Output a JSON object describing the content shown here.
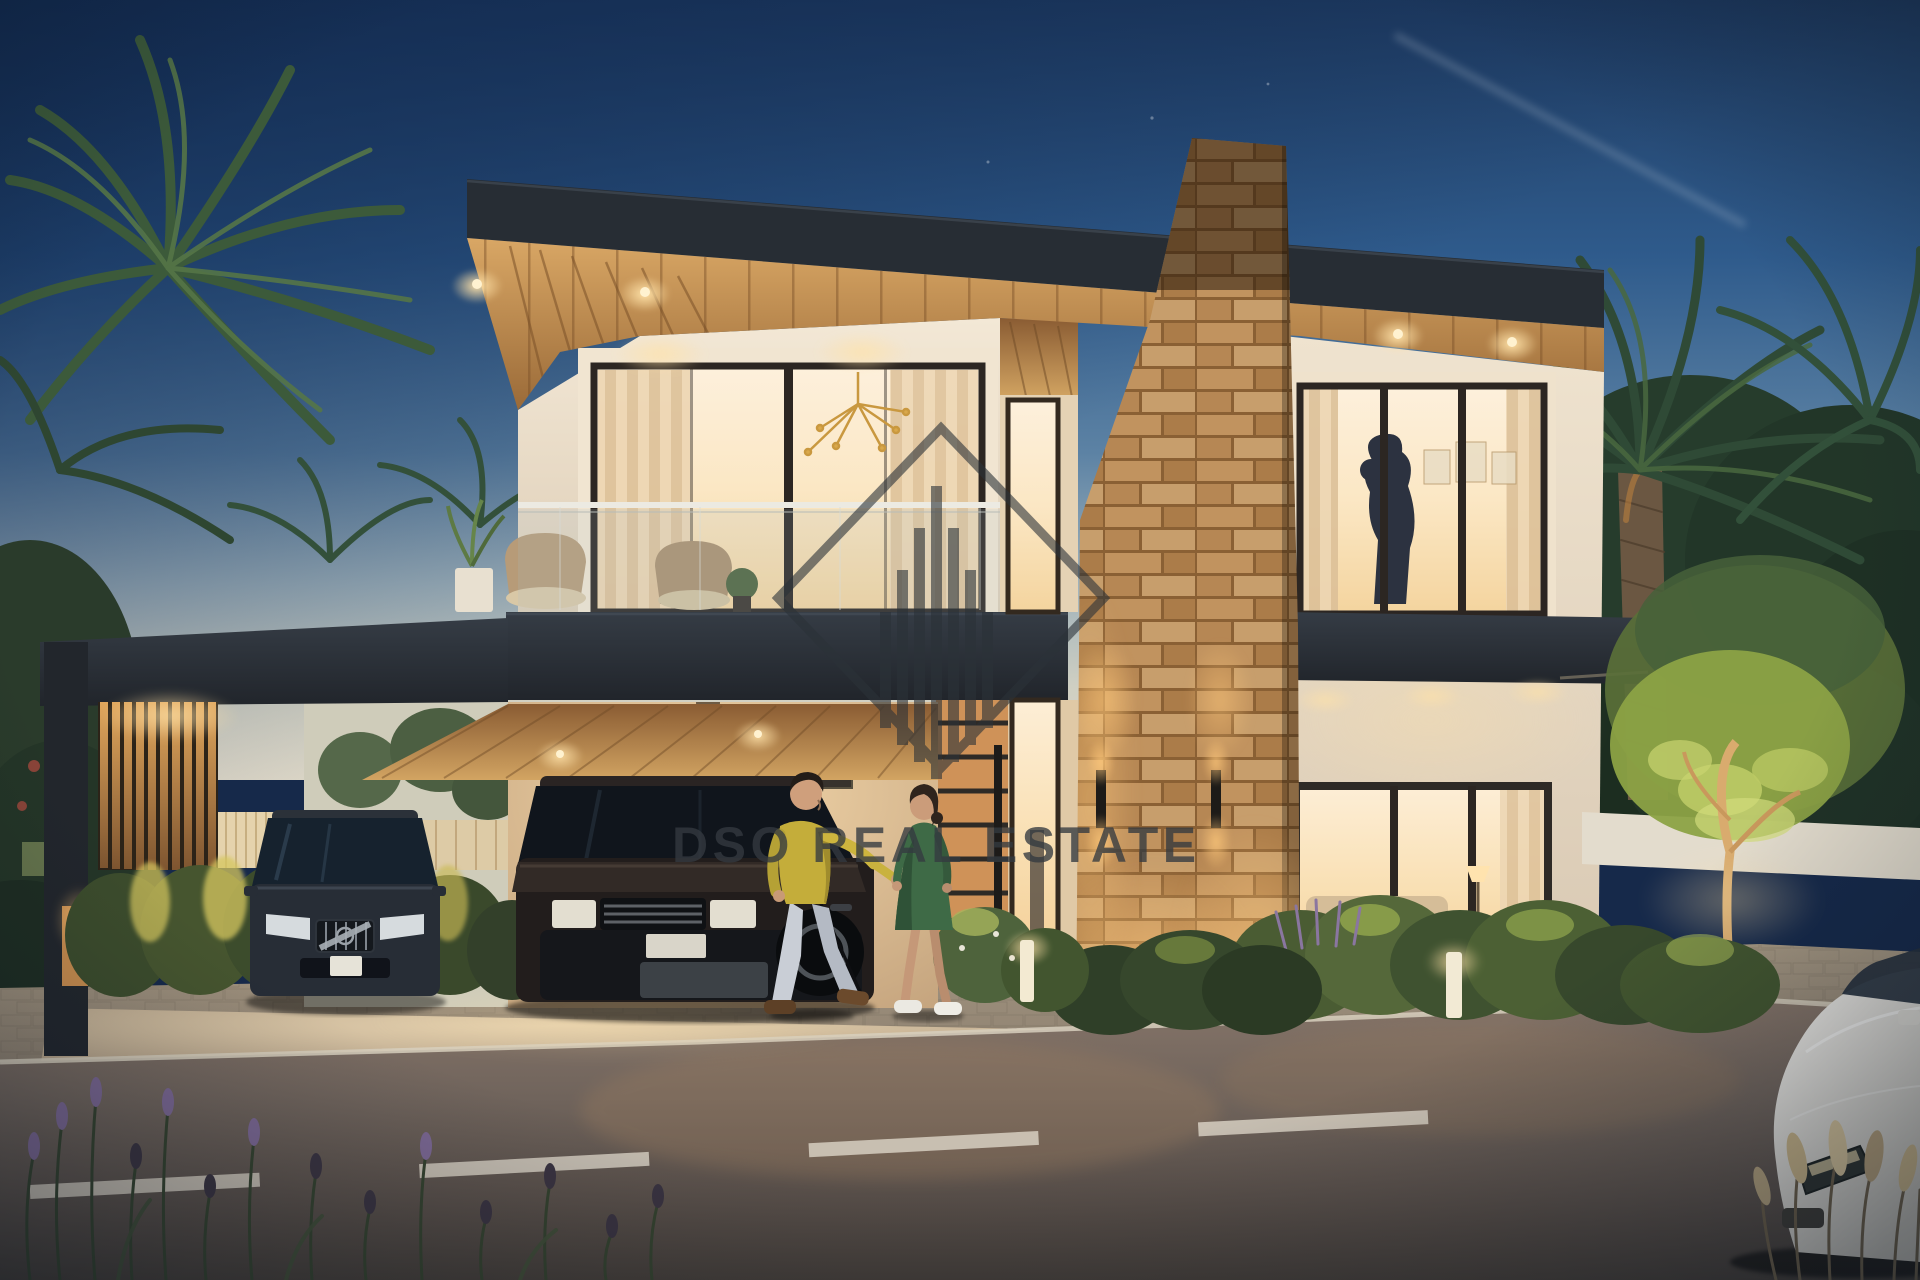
{
  "scene": {
    "title": "Modern two-storey villa exterior rendering at dusk with carport, stone feature column, palm trees and street"
  },
  "watermark": {
    "text": "DSO REAL ESTATE",
    "logo_icon": "diamond-skyline-logo"
  },
  "colors": {
    "sky_top": "#1e3a60",
    "sky_horizon": "#ded8c8",
    "roof_fascia": "#272d34",
    "soffit_wood": "#c08a4e",
    "wall_cream": "#ead9c2",
    "window_glow": "#f9dfae",
    "stone_cladding": "#b98a56",
    "hedge_green": "#46552f",
    "asphalt": "#6f635c",
    "watermark_gray": "#343a40",
    "sweater_yellow": "#c4ad3a",
    "dress_green": "#3e6a46"
  }
}
